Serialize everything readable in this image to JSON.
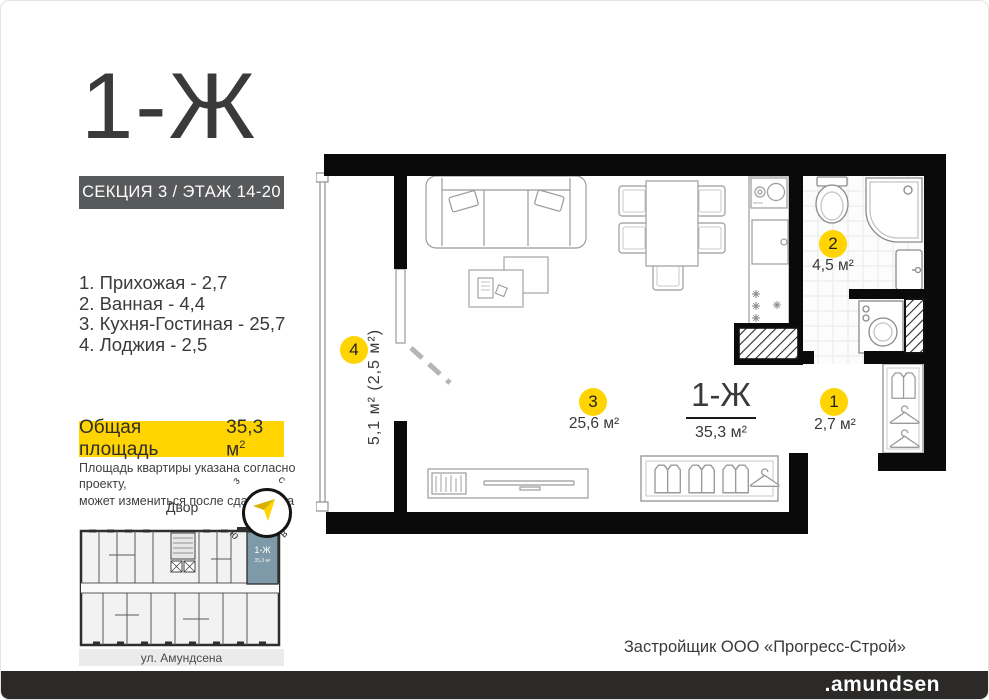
{
  "header": {
    "title": "1-Ж",
    "section_badge": "СЕКЦИЯ 3 / ЭТАЖ 14-20"
  },
  "room_list": [
    "1. Прихожая - 2,7",
    "2. Ванная - 4,4",
    "3. Кухня-Гостиная - 25,7",
    "4. Лоджия - 2,5"
  ],
  "total_area": {
    "label": "Общая площадь",
    "value": "35,3 м",
    "sup": "2"
  },
  "disclaimer": {
    "line1": "Площадь квартиры указана согласно проекту,",
    "line2": "может измениться  после сдачи дома"
  },
  "orientation": {
    "yard_label": "Двор",
    "compass": {
      "west": "з",
      "north": "с",
      "south": "ю",
      "east": "в"
    }
  },
  "minimap": {
    "unit_label": "1-Ж",
    "unit_area": "35,3 м²",
    "street": "ул. Амундсена"
  },
  "plan": {
    "unit": {
      "title": "1-Ж",
      "area": "35,3 м²"
    },
    "rooms": {
      "hallway": {
        "num": "1",
        "area": "2,7 м²"
      },
      "bathroom": {
        "num": "2",
        "area": "4,5 м²"
      },
      "kitchen_living": {
        "num": "3",
        "area": "25,6 м²"
      },
      "loggia": {
        "num": "4",
        "area": "5,1 м² (2,5 м²)"
      }
    }
  },
  "footer": {
    "developer": "Застройщик ООО «Прогресс-Строй»",
    "brand": ".amundsen"
  },
  "colors": {
    "accent_yellow": "#FFD400",
    "badge_gray": "#58595B",
    "wall_black": "#0a0a0a",
    "minimap_highlight": "#7E99A8",
    "footer_bar": "#2B2A29"
  }
}
